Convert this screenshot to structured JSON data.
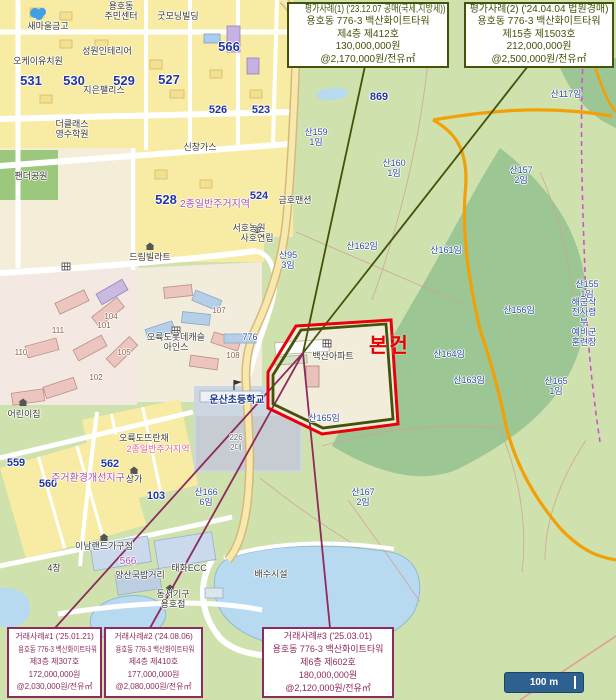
{
  "map": {
    "subject_label": "본건",
    "scale_bar": {
      "label": "100 m"
    },
    "colors": {
      "appraisal_case": "#44520a",
      "transaction_case": "#8e2a5c",
      "subject": "#e60000",
      "scale_bar_bg": "#2e6090",
      "forest": "#9cc794",
      "urban": "#f8eca4",
      "water": "#b8daf0"
    },
    "labels": [
      {
        "t": "새마을금고",
        "x": 48,
        "y": 26,
        "c": ""
      },
      {
        "t": "용호동\n주민센터",
        "x": 121,
        "y": 11,
        "c": ""
      },
      {
        "t": "굿모닝빌딩",
        "x": 178,
        "y": 16,
        "c": ""
      },
      {
        "t": "오케이유치원",
        "x": 38,
        "y": 61,
        "c": ""
      },
      {
        "t": "성원인테리어",
        "x": 107,
        "y": 51,
        "c": ""
      },
      {
        "t": "지은팰리스",
        "x": 104,
        "y": 90,
        "c": ""
      },
      {
        "t": "더클래스\n영수학원",
        "x": 72,
        "y": 129,
        "c": ""
      },
      {
        "t": "팬더공원",
        "x": 31,
        "y": 176,
        "c": ""
      },
      {
        "t": "신창가스",
        "x": 200,
        "y": 147,
        "c": ""
      },
      {
        "t": "드림빌라트",
        "x": 150,
        "y": 257,
        "c": ""
      },
      {
        "t": "사호연립",
        "x": 257,
        "y": 238,
        "c": ""
      },
      {
        "t": "금호맨션",
        "x": 295,
        "y": 200,
        "c": ""
      },
      {
        "t": "서호농원",
        "x": 249,
        "y": 228,
        "c": ""
      },
      {
        "t": "오륙도롯데캐슬\n아인스",
        "x": 176,
        "y": 342,
        "c": ""
      },
      {
        "t": "운산초등학교",
        "x": 237,
        "y": 401,
        "c": "s"
      },
      {
        "t": "백산아파트",
        "x": 333,
        "y": 356,
        "c": ""
      },
      {
        "t": "어린이집",
        "x": 24,
        "y": 414,
        "c": ""
      },
      {
        "t": "오륙도뜨란채",
        "x": 144,
        "y": 438,
        "c": ""
      },
      {
        "t": "상가",
        "x": 134,
        "y": 479,
        "c": ""
      },
      {
        "t": "태화ECC",
        "x": 189,
        "y": 568,
        "c": ""
      },
      {
        "t": "동서기구\n용호점",
        "x": 173,
        "y": 599,
        "c": ""
      },
      {
        "t": "이남랜드가구점",
        "x": 104,
        "y": 546,
        "c": ""
      },
      {
        "t": "배수시설",
        "x": 271,
        "y": 574,
        "c": ""
      },
      {
        "t": "양산국밥거리",
        "x": 140,
        "y": 575,
        "c": ""
      },
      {
        "t": "4창",
        "x": 54,
        "y": 568,
        "c": ""
      },
      {
        "t": "해군작전사령부\n예비군훈련장",
        "x": 584,
        "y": 322,
        "c": "p"
      },
      {
        "t": "산159\n1임",
        "x": 316,
        "y": 137,
        "c": "p"
      },
      {
        "t": "산160\n1임",
        "x": 394,
        "y": 168,
        "c": "p"
      },
      {
        "t": "산162임",
        "x": 362,
        "y": 246,
        "c": "p"
      },
      {
        "t": "산161임",
        "x": 446,
        "y": 250,
        "c": "p"
      },
      {
        "t": "산163임",
        "x": 469,
        "y": 380,
        "c": "p"
      },
      {
        "t": "산164임",
        "x": 449,
        "y": 354,
        "c": "p"
      },
      {
        "t": "산165임",
        "x": 324,
        "y": 418,
        "c": "p"
      },
      {
        "t": "산165\n1임",
        "x": 556,
        "y": 386,
        "c": "p"
      },
      {
        "t": "산166\n6임",
        "x": 206,
        "y": 497,
        "c": "p"
      },
      {
        "t": "산167\n2임",
        "x": 363,
        "y": 497,
        "c": "p"
      },
      {
        "t": "산156임",
        "x": 519,
        "y": 310,
        "c": "p"
      },
      {
        "t": "산155\n1임",
        "x": 587,
        "y": 289,
        "c": "p"
      },
      {
        "t": "산157\n2임",
        "x": 521,
        "y": 175,
        "c": "p"
      },
      {
        "t": "산117임",
        "x": 566,
        "y": 94,
        "c": "p"
      },
      {
        "t": "산95\n3임",
        "x": 288,
        "y": 260,
        "c": "p"
      },
      {
        "t": "776",
        "x": 250,
        "y": 337,
        "c": "p"
      },
      {
        "t": "226\n2대",
        "x": 236,
        "y": 443,
        "c": "g"
      },
      {
        "t": "531",
        "x": 31,
        "y": 81,
        "c": "n"
      },
      {
        "t": "530",
        "x": 74,
        "y": 81,
        "c": "n"
      },
      {
        "t": "529",
        "x": 124,
        "y": 81,
        "c": "n"
      },
      {
        "t": "527",
        "x": 169,
        "y": 80,
        "c": "n"
      },
      {
        "t": "566",
        "x": 229,
        "y": 47,
        "c": "n"
      },
      {
        "t": "528",
        "x": 166,
        "y": 200,
        "c": "n"
      },
      {
        "t": "526",
        "x": 218,
        "y": 110,
        "c": "n2"
      },
      {
        "t": "523",
        "x": 261,
        "y": 110,
        "c": "n2"
      },
      {
        "t": "524",
        "x": 259,
        "y": 196,
        "c": "n2"
      },
      {
        "t": "562",
        "x": 110,
        "y": 464,
        "c": "n2"
      },
      {
        "t": "560",
        "x": 48,
        "y": 484,
        "c": "n2"
      },
      {
        "t": "559",
        "x": 16,
        "y": 463,
        "c": "n2"
      },
      {
        "t": "869",
        "x": 379,
        "y": 97,
        "c": "n2"
      },
      {
        "t": "103",
        "x": 156,
        "y": 496,
        "c": "n2"
      },
      {
        "t": "2종일반주거지역",
        "x": 215,
        "y": 205,
        "c": "z"
      },
      {
        "t": "주거환경개선지구",
        "x": 88,
        "y": 479,
        "c": "z"
      },
      {
        "t": "566",
        "x": 128,
        "y": 562,
        "c": "z"
      },
      {
        "t": "2종일반주거지역",
        "x": 158,
        "y": 449,
        "c": "zp"
      },
      {
        "t": "110",
        "x": 21,
        "y": 353,
        "c": "a"
      },
      {
        "t": "111",
        "x": 58,
        "y": 331,
        "c": "a"
      },
      {
        "t": "101",
        "x": 104,
        "y": 326,
        "c": "a"
      },
      {
        "t": "104",
        "x": 111,
        "y": 317,
        "c": "a"
      },
      {
        "t": "102",
        "x": 96,
        "y": 378,
        "c": "a"
      },
      {
        "t": "105",
        "x": 124,
        "y": 353,
        "c": "a"
      },
      {
        "t": "107",
        "x": 219,
        "y": 311,
        "c": "a"
      },
      {
        "t": "108",
        "x": 233,
        "y": 356,
        "c": "a"
      }
    ]
  },
  "cases": {
    "appraisal": [
      {
        "title": "평가사례(1) ('23.12.07 공매(국세,지방세))",
        "address": "용호동 776-3 백산화이트타워",
        "unit": "제4층 제412호",
        "price": "130,000,000원",
        "unit_price": "@2,170,000원/전유㎡"
      },
      {
        "title": "평가사례(2) ('24.04.04 법원경매)",
        "address": "용호동 776-3 백산화이트타워",
        "unit": "제15층 제1503호",
        "price": "212,000,000원",
        "unit_price": "@2,500,000원/전유㎡"
      }
    ],
    "transaction": [
      {
        "title": "거래사례#1 ('25.01.21)",
        "address": "용호동 776-3 백산화이트타워",
        "unit": "제3층 제307호",
        "price": "172,000,000원",
        "unit_price": "@2,030,000원/전유㎡"
      },
      {
        "title": "거래사례#2 ('24.08.06)",
        "address": "용호동 776-3 백산화이트타워",
        "unit": "제4층 제410호",
        "price": "177,000,000원",
        "unit_price": "@2,080,000원/전유㎡"
      },
      {
        "title": "거래사례#3 ('25.03.01)",
        "address": "용호동 776-3 백산화이트타워",
        "unit": "제6층 제602호",
        "price": "180,000,000원",
        "unit_price": "@2,120,000원/전유㎡"
      }
    ]
  }
}
